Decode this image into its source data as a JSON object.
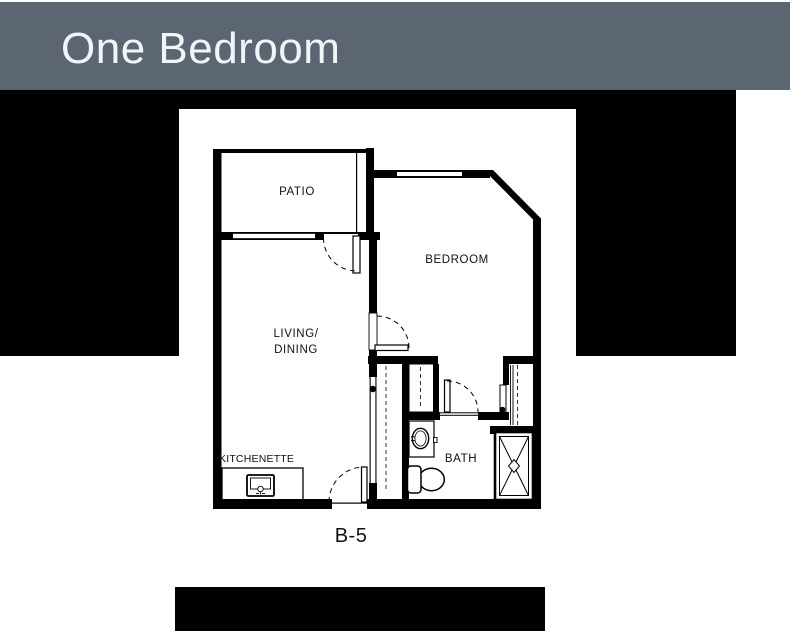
{
  "header": {
    "title": "One Bedroom",
    "bg_color": "#5c6672",
    "text_color": "#f2f5f7"
  },
  "floor_plan": {
    "labels": {
      "patio": "PATIO",
      "bedroom": "BEDROOM",
      "living_line1": "LIVING/",
      "living_line2": "DINING",
      "kitchenette": "KITCHENETTE",
      "bath": "BATH"
    },
    "unit_label": "B-5",
    "wall_color": "#000000",
    "paper_color": "#ffffff",
    "backdrop_color": "#010101"
  }
}
